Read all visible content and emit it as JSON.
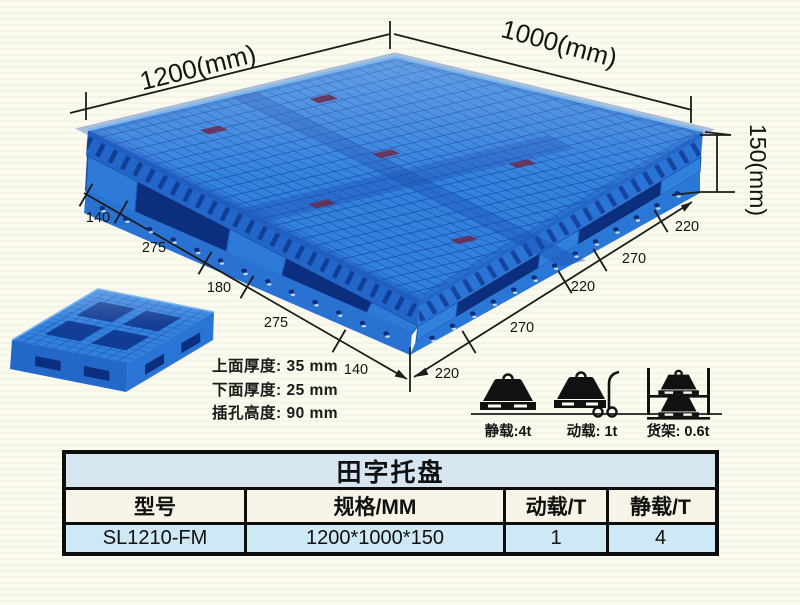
{
  "page": {
    "background": "#fbfaee"
  },
  "colors": {
    "pallet_blue": "#2f80dc",
    "pallet_dark": "#0c2e7e",
    "pallet_grid": "#1747ae",
    "line_color": "#1c1c1c",
    "table_title_bg": "#d5e6f1",
    "table_header_bg": "#f7f3e6",
    "table_data_bg": "#cfe8f5"
  },
  "dimensions": {
    "top_left_edge": "1200(mm)",
    "top_right_edge": "1000(mm)",
    "height": "150(mm)",
    "left_chain": [
      "140",
      "275",
      "180",
      "275",
      "140"
    ],
    "right_chain": [
      "220",
      "270",
      "220",
      "270",
      "220"
    ]
  },
  "thickness_notes": [
    "上面厚度: 35 mm",
    "下面厚度: 25 mm",
    "插孔高度: 90 mm"
  ],
  "loads": [
    {
      "icon": "static-load-icon",
      "label": "静载:4t"
    },
    {
      "icon": "dynamic-load-icon",
      "label": "动载: 1t"
    },
    {
      "icon": "rack-load-icon",
      "label": "货架: 0.6t"
    }
  ],
  "table": {
    "title": "田字托盘",
    "headers": [
      "型号",
      "规格/MM",
      "动载/T",
      "静载/T"
    ],
    "rows": [
      [
        "SL1210-FM",
        "1200*1000*150",
        "1",
        "4"
      ]
    ]
  }
}
